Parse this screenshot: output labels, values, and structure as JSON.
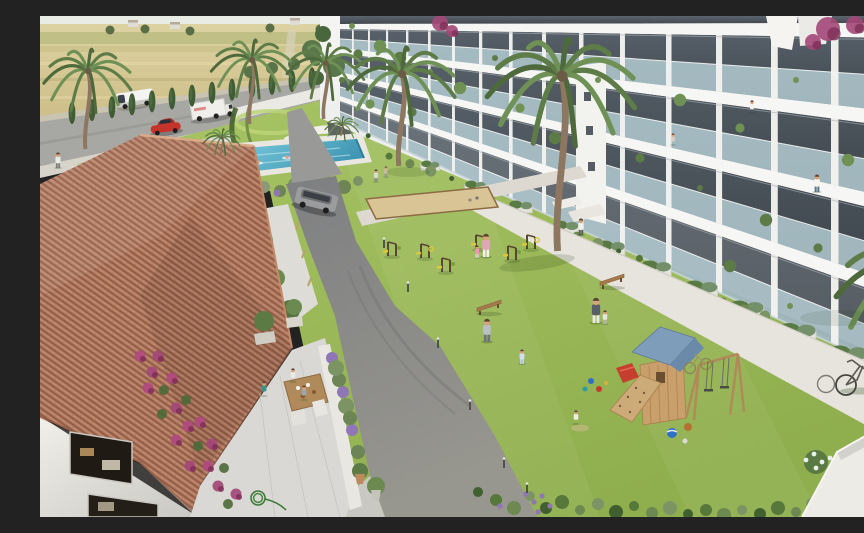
{
  "scene": {
    "description": "Aerial 3D architectural rendering of a Mediterranean residential complex: white apartment building with glass balconies, communal lawn with outdoor gym and wooden playground, swimming pool, terracotta-roofed clubhouse with dining terrace, palm trees, road with vehicles and wheat fields beyond",
    "elements": {
      "countryside": "dry wheat fields with distant farm buildings",
      "road": "perimeter road with van, box truck and red car",
      "cypresses": "cypress hedge along boundary wall",
      "pool": "communal swimming pool with swimmers",
      "clubhouse": "clubhouse with terracotta tile roof, bougainvillea and dining terrace",
      "driveway": "curved asphalt internal driveway with grey SUV",
      "lawn": "central lawn with outdoor fitness equipment, petanque court and benches",
      "playground": "wooden playground tower with blue roof, slide and swings",
      "apartments": "white apartment building with tiered glass balconies and residents",
      "palms": "tall palm trees across the courtyard"
    }
  },
  "palette": {
    "sky": "#e9ece4",
    "field": "#d4c690",
    "field_dark": "#c3b278",
    "road": "#a7a7a4",
    "asphalt": "#8b8b89",
    "lawn": "#9cba5b",
    "lawn_light": "#aac768",
    "path": "#e5e2da",
    "pool": "#5cb6cf",
    "pool_deep": "#3a92ad",
    "roof_tile": "#b0785e",
    "roof_shadow": "#8d5a45",
    "wall_white": "#f2f1ec",
    "facade": "#eff1f0",
    "glazing": "#39424b",
    "glass": "#bcd6dd",
    "cypress": "#3f5c34",
    "palm_green": "#5e7c48",
    "trunk": "#8d7760",
    "sand": "#d9c495",
    "wood": "#b08a58",
    "bougainvillea": "#a34878",
    "playground_roof": "#7e9dbb",
    "accent_red": "#c63e2e",
    "accent_yellow": "#d8ca3a",
    "suv_grey": "#9b9c9e"
  },
  "build": {
    "facade": {
      "x0": 300,
      "x1": 864,
      "slabs": [
        [
          [
            8,
            7
          ],
          [
            13,
            22
          ]
        ],
        [
          [
            32,
            97
          ],
          [
            37,
            112
          ]
        ],
        [
          [
            56,
            185
          ],
          [
            61,
            200
          ]
        ],
        [
          [
            80,
            270
          ],
          [
            85,
            285
          ]
        ]
      ],
      "floors": [
        [
          [
            13,
            22
          ],
          [
            32,
            97
          ]
        ],
        [
          [
            37,
            112
          ],
          [
            56,
            185
          ]
        ],
        [
          [
            61,
            200
          ],
          [
            80,
            270
          ]
        ],
        [
          [
            85,
            285
          ],
          [
            105,
            360
          ]
        ]
      ],
      "top_strip": [
        [
          0,
          0
        ],
        [
          8,
          7
        ]
      ],
      "base": [
        105,
        360
      ],
      "partitions": [
        312,
        328,
        346,
        366,
        388,
        412,
        439,
        469,
        502,
        539,
        580,
        626,
        676,
        731,
        791,
        852
      ],
      "planter_ts": [
        0.16,
        0.24,
        0.32,
        0.4,
        0.48,
        0.56,
        0.64,
        0.72,
        0.81,
        0.9
      ]
    },
    "cypresses": {
      "x0": 32,
      "step": 20,
      "n": 13,
      "y0": 97,
      "slope": -0.145
    },
    "palms": [
      [
        48,
        55,
        1.3,
        78
      ],
      [
        212,
        44,
        1.2,
        64
      ],
      [
        286,
        47,
        1.15,
        56
      ],
      [
        362,
        58,
        1.6,
        92
      ],
      [
        522,
        60,
        2.2,
        175
      ],
      [
        182,
        122,
        0.55,
        17
      ],
      [
        302,
        109,
        0.5,
        11
      ],
      [
        878,
        258,
        2.4,
        0
      ],
      [
        876,
        126,
        1.5,
        0
      ]
    ],
    "balcony_plants": [
      [
        312,
        10
      ],
      [
        318,
        38
      ],
      [
        340,
        30
      ],
      [
        302,
        64
      ],
      [
        330,
        88
      ],
      [
        360,
        42
      ],
      [
        390,
        56
      ],
      [
        372,
        96
      ],
      [
        420,
        72
      ],
      [
        455,
        42
      ],
      [
        480,
        92
      ],
      [
        515,
        122
      ],
      [
        558,
        64
      ],
      [
        600,
        142
      ],
      [
        640,
        84
      ],
      [
        660,
        172
      ],
      [
        700,
        112
      ],
      [
        726,
        204
      ],
      [
        756,
        64
      ],
      [
        778,
        232
      ],
      [
        808,
        144
      ],
      [
        838,
        256
      ],
      [
        850,
        64
      ],
      [
        690,
        250
      ],
      [
        750,
        290
      ]
    ],
    "bougainvillea": [
      [
        400,
        7,
        8
      ],
      [
        412,
        15,
        6
      ],
      [
        788,
        13,
        12
      ],
      [
        773,
        26,
        8
      ],
      [
        815,
        9,
        9
      ],
      [
        852,
        152,
        10
      ],
      [
        841,
        172,
        7
      ]
    ],
    "people": [
      [
        18,
        152,
        16,
        "#eceae4",
        "#7a7a74",
        0
      ],
      [
        336,
        166,
        13,
        "#d9d9d3",
        "#8b8b83",
        0
      ],
      [
        346,
        161,
        11,
        "#cdbdad",
        "#99938b",
        0
      ],
      [
        541,
        219,
        17,
        "#f1f0ea",
        "#5b5b56",
        0
      ],
      [
        446,
        241,
        24,
        "#e2a7b7",
        "#f2f1ec",
        0
      ],
      [
        437,
        242,
        13,
        "#e79aad",
        "#d8d4cc",
        0
      ],
      [
        556,
        307,
        26,
        "#595f66",
        "#eae9e4",
        0
      ],
      [
        565,
        308,
        14,
        "#e6e4db",
        "#b9b3a7",
        0
      ],
      [
        447,
        326,
        24,
        "#b9bfc5",
        "#6e7379",
        0
      ],
      [
        482,
        348,
        15,
        "#d0e1ea",
        "#c2d4de",
        0
      ],
      [
        536,
        408,
        14,
        "#eeede7",
        "#55595d",
        1
      ],
      [
        712,
        97,
        13,
        "#f2f1ea",
        "#4a4f55",
        1
      ],
      [
        633,
        129,
        12,
        "#d9d0c5",
        "#6b6258",
        1
      ],
      [
        777,
        176,
        18,
        "#f5f4ef",
        "#5e7287",
        0
      ],
      [
        224,
        380,
        15,
        "#3f8f8a",
        "#3b3b37",
        1
      ],
      [
        253,
        366,
        14,
        "#edebe3",
        "#6c5c4b",
        1
      ],
      [
        264,
        384,
        15,
        "#9ba5ad",
        "#4b4641",
        1
      ]
    ],
    "swimmers": [
      [
        203,
        148
      ],
      [
        218,
        146
      ],
      [
        247,
        141
      ],
      [
        282,
        138
      ]
    ],
    "bollards": [
      [
        344,
        232
      ],
      [
        368,
        276
      ],
      [
        398,
        332
      ],
      [
        430,
        394
      ],
      [
        464,
        452
      ],
      [
        487,
        477
      ]
    ],
    "fitness": [
      [
        352,
        240
      ],
      [
        385,
        242
      ],
      [
        406,
        256
      ],
      [
        440,
        233
      ],
      [
        472,
        244
      ],
      [
        491,
        233
      ]
    ],
    "benches": [
      [
        560,
        266
      ],
      [
        437,
        292
      ]
    ],
    "pool_shrubs": [
      [
        178,
        168,
        5
      ],
      [
        192,
        172,
        6
      ],
      [
        208,
        176,
        5
      ],
      [
        224,
        171,
        6
      ],
      [
        240,
        175,
        5
      ],
      [
        256,
        169,
        6
      ],
      [
        272,
        173,
        5
      ],
      [
        288,
        167,
        6
      ],
      [
        304,
        171,
        5
      ],
      [
        318,
        165,
        5
      ]
    ],
    "left_shrubs": [
      [
        64,
        158
      ],
      [
        80,
        154
      ],
      [
        96,
        150
      ],
      [
        112,
        146
      ],
      [
        128,
        142
      ],
      [
        146,
        138
      ],
      [
        162,
        134
      ],
      [
        178,
        131
      ]
    ],
    "terrace_shrubs": [
      [
        292,
        342
      ],
      [
        299,
        364
      ],
      [
        306,
        390
      ],
      [
        312,
        414
      ],
      [
        318,
        436
      ],
      [
        296,
        352
      ],
      [
        303,
        376
      ],
      [
        310,
        402
      ]
    ],
    "border_shrubs": [
      [
        438,
        476
      ],
      [
        456,
        484
      ],
      [
        474,
        492
      ],
      [
        490,
        480
      ],
      [
        506,
        492
      ],
      [
        522,
        486
      ],
      [
        540,
        494
      ],
      [
        558,
        488
      ],
      [
        576,
        496
      ],
      [
        594,
        490
      ],
      [
        612,
        497
      ],
      [
        630,
        492
      ],
      [
        648,
        498
      ],
      [
        666,
        494
      ],
      [
        684,
        499
      ],
      [
        702,
        494
      ],
      [
        720,
        498
      ],
      [
        738,
        492
      ],
      [
        756,
        496
      ],
      [
        772,
        488
      ],
      [
        788,
        492
      ]
    ],
    "lavender": [
      [
        486,
        478
      ],
      [
        494,
        486
      ],
      [
        502,
        480
      ],
      [
        510,
        490
      ],
      [
        498,
        496
      ],
      [
        460,
        490
      ]
    ],
    "white_bush": [
      [
        766,
        444
      ],
      [
        774,
        438
      ],
      [
        782,
        446
      ],
      [
        776,
        452
      ],
      [
        790,
        442
      ]
    ],
    "red_bush": [
      [
        846,
        430
      ],
      [
        854,
        438
      ],
      [
        840,
        440
      ]
    ],
    "far_trees": [
      [
        70,
        14
      ],
      [
        105,
        13
      ],
      [
        150,
        15
      ],
      [
        230,
        12
      ],
      [
        280,
        13
      ],
      [
        350,
        12
      ],
      [
        450,
        11
      ],
      [
        520,
        12
      ]
    ],
    "far_buildings": [
      [
        88,
        4
      ],
      [
        130,
        6
      ],
      [
        250,
        2
      ],
      [
        320,
        4
      ],
      [
        420,
        5
      ],
      [
        470,
        6
      ]
    ],
    "wall_trees": [
      [
        210,
        56
      ],
      [
        232,
        52
      ],
      [
        254,
        48
      ],
      [
        276,
        44
      ]
    ],
    "corner_trees": [
      [
        272,
        34,
        10
      ],
      [
        283,
        18,
        8
      ],
      [
        294,
        50,
        11
      ],
      [
        277,
        62,
        7
      ]
    ]
  }
}
